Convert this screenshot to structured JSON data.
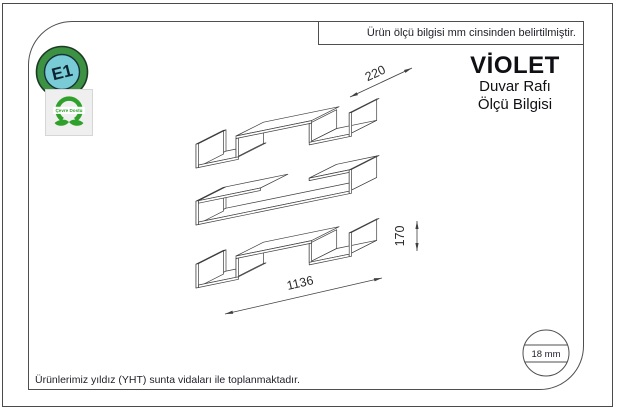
{
  "frame": {
    "top_note": "Ürün ölçü bilgisi mm cinsinden belirtilmiştir.",
    "bottom_note": "Ürünlerimiz yıldız (YHT) sunta vidaları ile toplanmaktadır."
  },
  "title_block": {
    "product_name": "VİOLET",
    "line2": "Duvar Rafı",
    "line3": "Ölçü Bilgisi"
  },
  "badges": {
    "e1_label": "E1",
    "eco_label": "Çevre Dostu"
  },
  "dimensions": {
    "depth_mm": "220",
    "height_mm": "170",
    "length_mm": "1136",
    "panel_thickness": "18 mm"
  },
  "colors": {
    "line": "#3f3f3f",
    "e1_ring_green": "#3c9142",
    "e1_inner_teal": "#79ccd6",
    "eco_green": "#2fa12b"
  }
}
